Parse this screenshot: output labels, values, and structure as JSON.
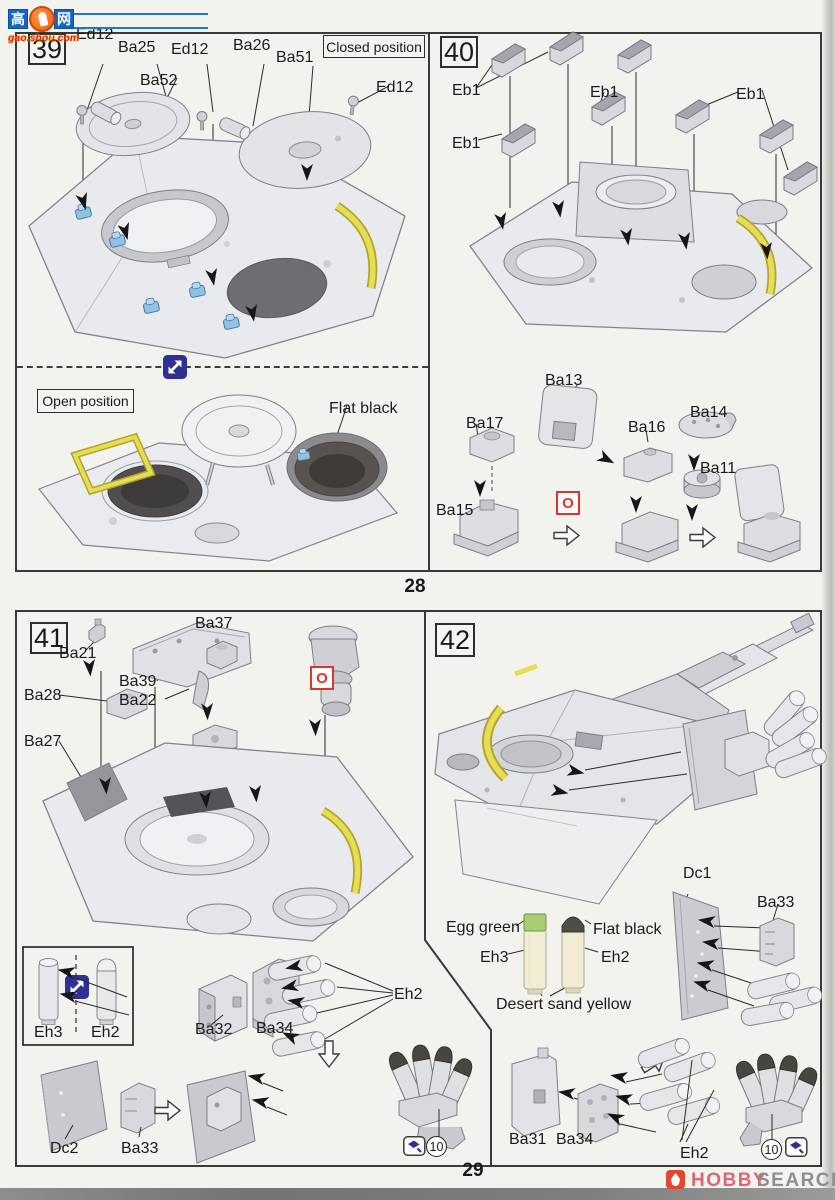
{
  "watermark": {
    "left_char": "高",
    "right_char": "网",
    "url": "gao.shou.com"
  },
  "page_numbers": {
    "top": "28",
    "bottom": "29"
  },
  "brand": {
    "hobby": "HOBBY",
    "search": "SEARCH"
  },
  "symbols": {
    "optional_parts": "O",
    "count_badge": "10"
  },
  "colors": {
    "accent_red": "#d8372a",
    "icon_blue": "#2e3192",
    "part_highlight_blue": "#92c2e2",
    "handle_yellow": "#e7dd55",
    "egg_green": "#a9cd72",
    "flat_black": "#4b4f45",
    "desert_sand_yellow": "#f2ecd4",
    "brand_red": "#dd6673",
    "watermark_blue": "#1565c8",
    "watermark_red": "#e81818"
  },
  "step39": {
    "number": "39",
    "closed_position": "Closed position",
    "open_position": "Open position",
    "paint_flat_black": "Flat black",
    "labels": {
      "ed12_a": "Ed12",
      "ba25": "Ba25",
      "ed12_b": "Ed12",
      "ba26": "Ba26",
      "ba51": "Ba51",
      "ba52": "Ba52",
      "ed12_c": "Ed12"
    }
  },
  "step40": {
    "number": "40",
    "labels": {
      "eb1_a": "Eb1",
      "eb1_b": "Eb1",
      "eb1_c": "Eb1",
      "eb1_d": "Eb1",
      "ba13": "Ba13",
      "ba17": "Ba17",
      "ba16": "Ba16",
      "ba14": "Ba14",
      "ba11": "Ba11",
      "ba15": "Ba15"
    }
  },
  "step41": {
    "number": "41",
    "labels": {
      "ba21": "Ba21",
      "ba37": "Ba37",
      "ba39": "Ba39",
      "ba22": "Ba22",
      "ba28": "Ba28",
      "ba27": "Ba27",
      "eh3": "Eh3",
      "eh2_box": "Eh2",
      "ba32": "Ba32",
      "ba34": "Ba34",
      "eh2_cluster": "Eh2",
      "dc2": "Dc2",
      "ba33": "Ba33"
    }
  },
  "step42": {
    "number": "42",
    "labels": {
      "dc1": "Dc1",
      "ba33": "Ba33",
      "eh3": "Eh3",
      "eh2": "Eh2",
      "ba31": "Ba31",
      "ba34": "Ba34",
      "eh2_cluster": "Eh2"
    },
    "paints": {
      "egg_green": "Egg green",
      "flat_black": "Flat black",
      "desert_sand_yellow": "Desert sand yellow"
    }
  }
}
